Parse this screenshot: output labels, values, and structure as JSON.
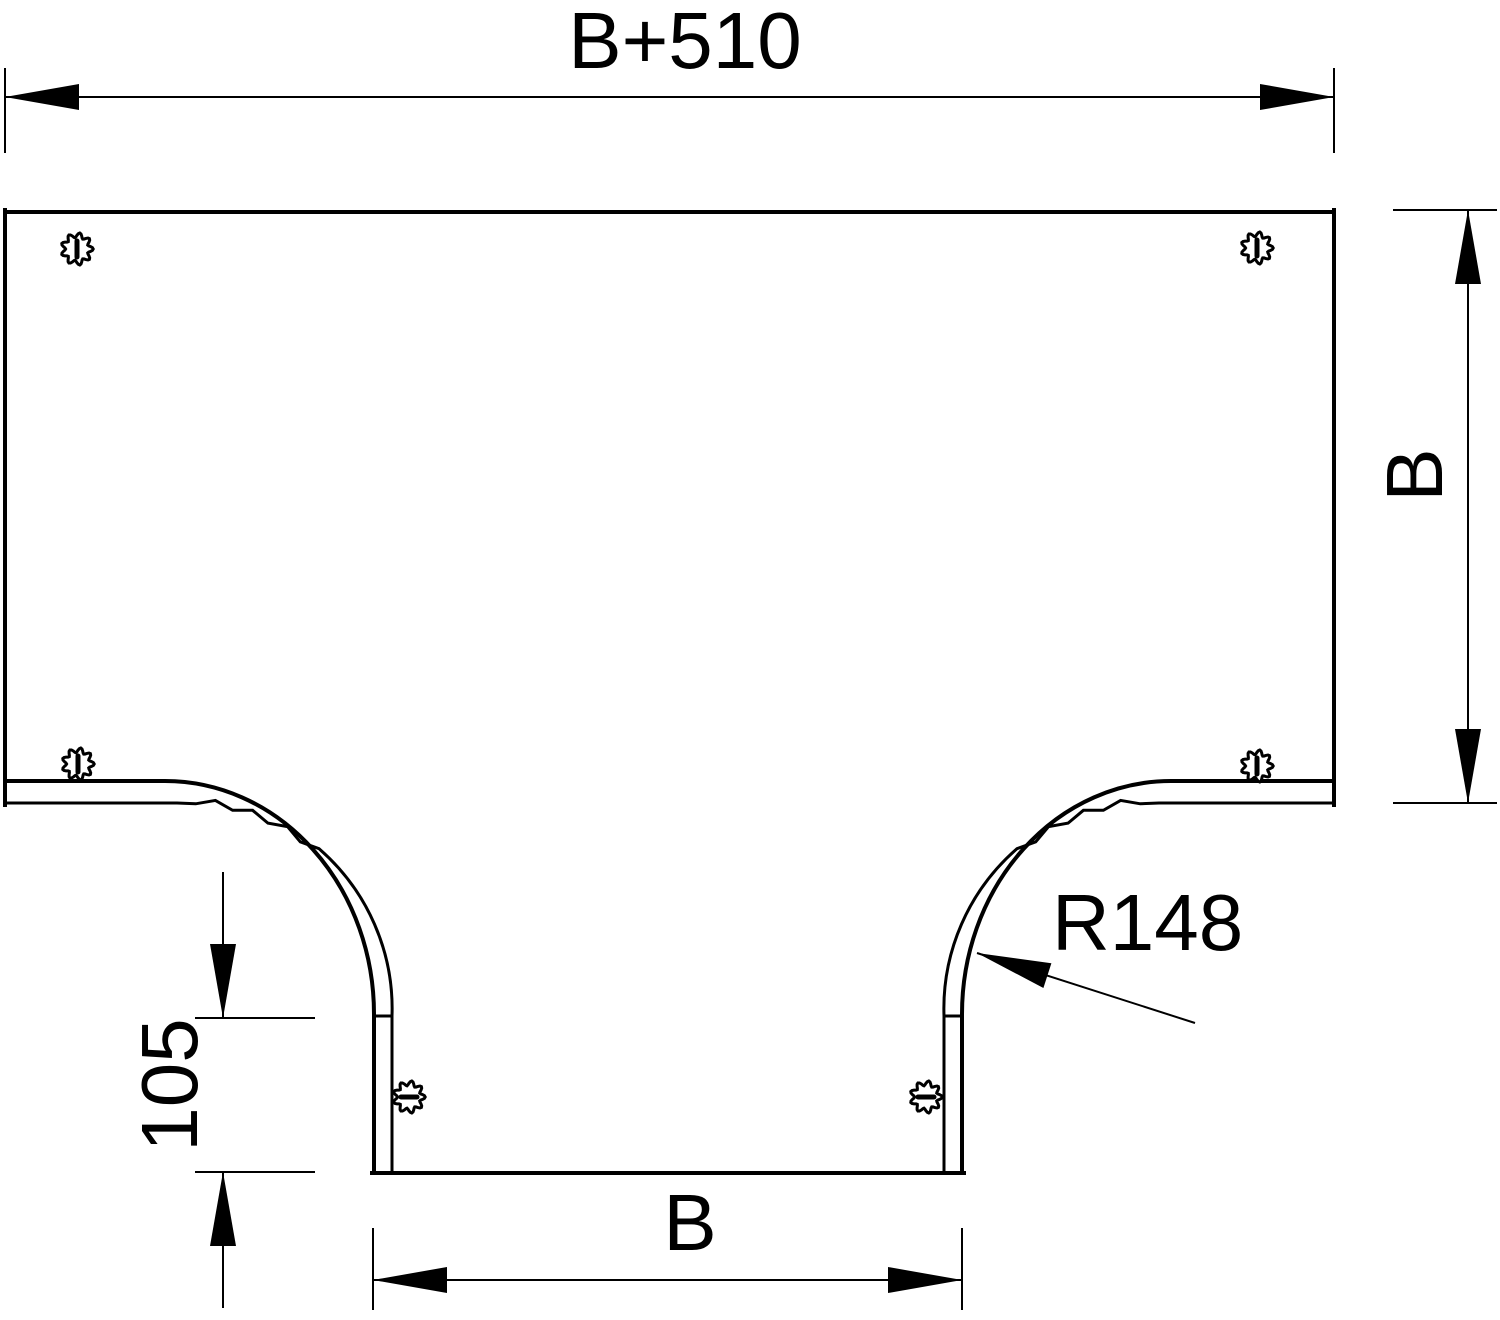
{
  "drawing": {
    "labels": {
      "width_top": "B+510",
      "depth_right": "B",
      "branch_width_bottom": "B",
      "flange_offset": "105",
      "bend_radius": "R148"
    },
    "colors": {
      "line": "#000000",
      "background": "#ffffff"
    },
    "screws": {
      "count": 6
    }
  }
}
